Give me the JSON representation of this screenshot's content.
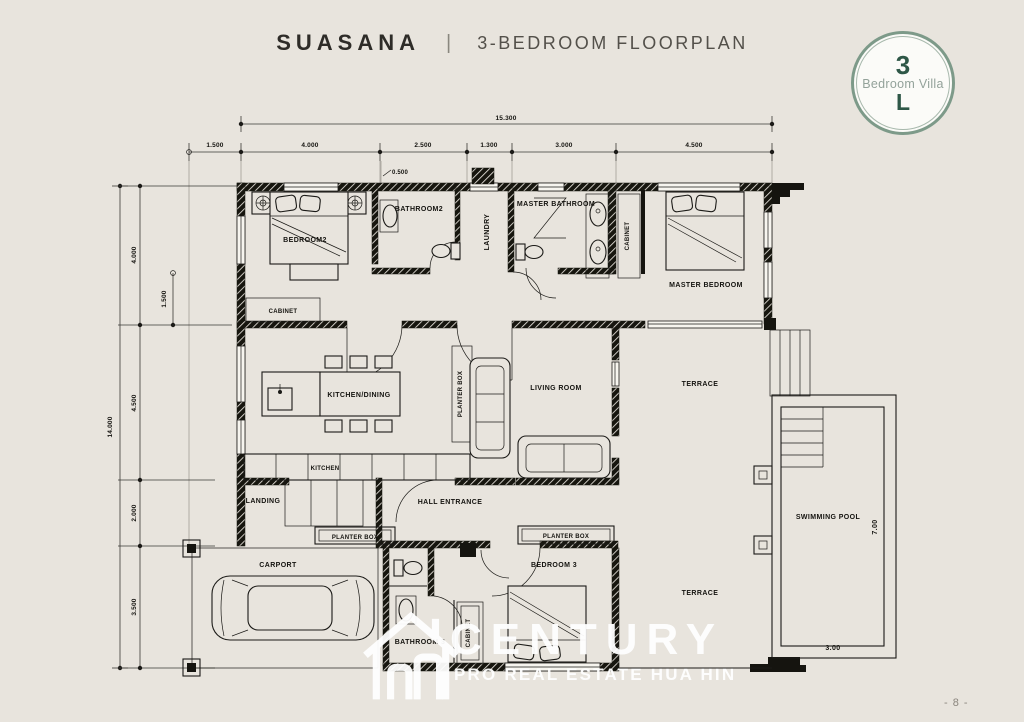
{
  "header": {
    "title": "SUASANA",
    "separator": "|",
    "subtitle": "3-BEDROOM FLOORPLAN"
  },
  "badge": {
    "top": "3",
    "middle": "Bedroom Villa",
    "bottom": "L"
  },
  "dims": {
    "top_overall": "15.300",
    "top_segments": [
      "1.500",
      "4.000",
      "2.500",
      "1.300",
      "3.000",
      "4.500"
    ],
    "top_minor": "0.500",
    "left_overall": "14.000",
    "left_segments": [
      "4.000",
      "4.500",
      "2.000",
      "3.500"
    ],
    "left_minor": "1.500",
    "pool_length": "7.00",
    "pool_width": "3.00"
  },
  "rooms": {
    "bedroom2": "BEDROOM2",
    "bathroom2": "BATHROOM2",
    "laundry": "LAUNDRY",
    "master_bathroom": "MASTER BATHROOM",
    "cabinet_master": "CABINET",
    "master_bedroom": "MASTER BEDROOM",
    "cabinet_bedroom2": "CABINET",
    "kitchen_dining": "KITCHEN/DINING",
    "living_room": "LIVING ROOM",
    "terrace_upper": "TERRACE",
    "planter_box_living": "PLANTER BOX",
    "kitchen": "KITCHEN",
    "landing": "LANDING",
    "hall_entrance": "HALL ENTRANCE",
    "planter_box_left": "PLANTER BOX",
    "planter_box_right": "PLANTER BOX",
    "carport": "CARPORT",
    "bathroom3": "BATHROOM 3",
    "cabinet_bedroom3": "CABINET",
    "bedroom3": "BEDROOM 3",
    "terrace_lower": "TERRACE",
    "swimming_pool": "SWIMMING POOL"
  },
  "watermark": {
    "brand": "CENTURY",
    "tagline": "PRO REAL ESTATE HUA HIN"
  },
  "footer": {
    "page_number": "- 8 -"
  },
  "colors": {
    "background": "#e8e4dd",
    "line": "#1b1a17",
    "badge_ring": "#7d9a89",
    "badge_text": "#2e5747",
    "badge_subtext": "#93a29a",
    "title": "#2e2c28",
    "subtitle": "#53504a",
    "watermark": "#ffffff"
  }
}
